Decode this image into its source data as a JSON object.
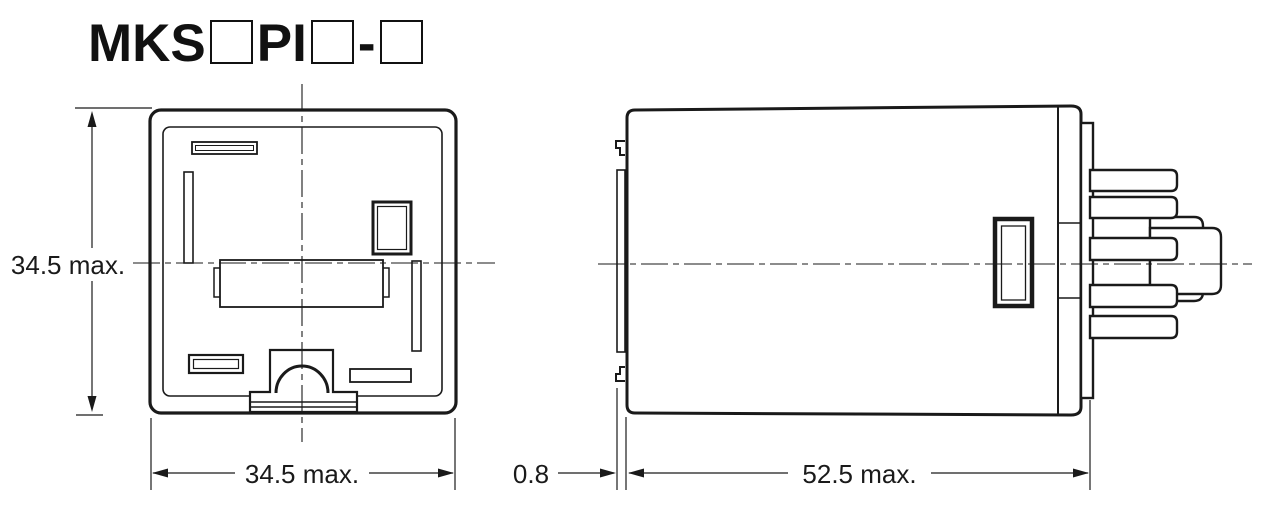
{
  "title": {
    "segments": [
      {
        "text": "MKS"
      },
      {
        "box": true
      },
      {
        "text": "PI"
      },
      {
        "box": true
      },
      {
        "text": "-"
      },
      {
        "box": true
      }
    ]
  },
  "dimensions": {
    "front_height": "34.5 max.",
    "front_width": "34.5 max.",
    "side_offset": "0.8",
    "side_depth": "52.5 max."
  },
  "colors": {
    "line": "#1a1a1a",
    "background": "#ffffff"
  }
}
